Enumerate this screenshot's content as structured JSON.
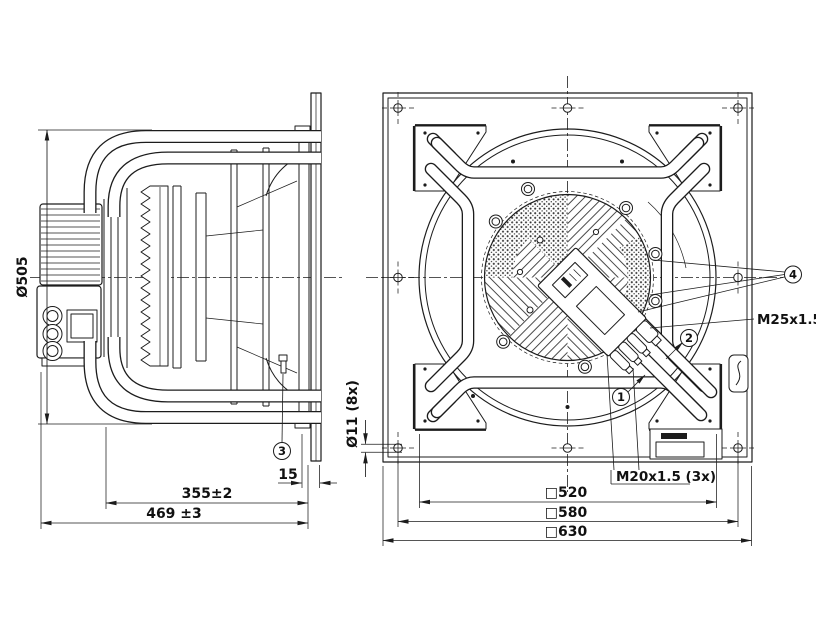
{
  "page": {
    "background": "#ffffff",
    "line_color": "#1c1c1c"
  },
  "side_view": {
    "dims": {
      "impeller_diameter": "Ø505",
      "motor_depth": "355±2",
      "total_depth": "469 ±3",
      "plate_thickness": "15"
    },
    "callouts": {
      "c3": "3"
    }
  },
  "front_view": {
    "dims": {
      "mounting_holes": "Ø11 (8x)",
      "inner_square": "□520",
      "hole_square": "□580",
      "outer_square": "□630"
    },
    "labels": {
      "gland_large": "M25x1.5",
      "gland_small": "M20x1.5 (3x)"
    },
    "callouts": {
      "c1": "1",
      "c2": "2",
      "c4": "4"
    }
  }
}
